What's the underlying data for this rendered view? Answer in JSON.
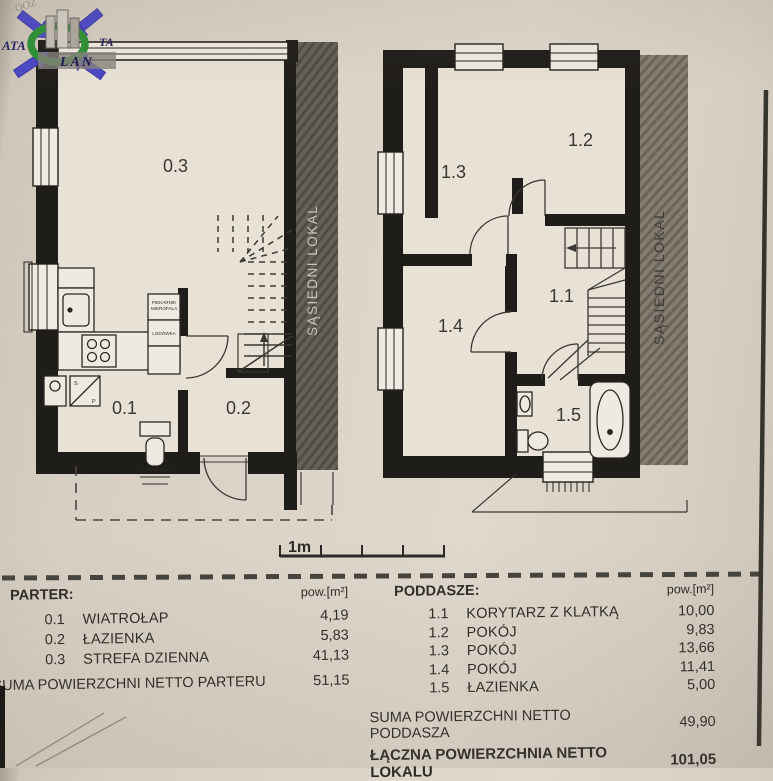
{
  "logo": {
    "text_left": "ATA",
    "text_right": "TA",
    "text_bottom": "LAN",
    "corner_script": "OOZ",
    "arrow_color": "#4b48c6",
    "ring_color": "#2d9136"
  },
  "plans": {
    "parter": {
      "rooms": {
        "r01": "0.1",
        "r02": "0.2",
        "r03": "0.3"
      },
      "adjacent_label": "SĄSIEDNI LOKAL",
      "kitchen": {
        "oven_line1": "PIEKARNIK",
        "oven_line2": "MIKROFALA",
        "fridge": "LODÓWKA"
      },
      "washer_letters": {
        "top": "S",
        "bottom": "P"
      }
    },
    "poddasze": {
      "rooms": {
        "r11": "1.1",
        "r12": "1.2",
        "r13": "1.3",
        "r14": "1.4",
        "r15": "1.5"
      },
      "adjacent_label": "SĄSIEDNI LOKAL"
    }
  },
  "scale_bar": {
    "label": "1m"
  },
  "tables": {
    "parter": {
      "title": "PARTER:",
      "unit_header": "pow.[m²]",
      "rows": [
        {
          "no": "0.1",
          "name": "WIATROŁAP",
          "area": "4,19"
        },
        {
          "no": "0.2",
          "name": "ŁAZIENKA",
          "area": "5,83"
        },
        {
          "no": "0.3",
          "name": "STREFA DZIENNA",
          "area": "41,13"
        }
      ],
      "total_label": "SUMA POWIERZCHNI NETTO PARTERU",
      "total_value": "51,15"
    },
    "poddasze": {
      "title": "PODDASZE:",
      "unit_header": "pow.[m²]",
      "rows": [
        {
          "no": "1.1",
          "name": "KORYTARZ Z KLATKĄ",
          "area": "10,00"
        },
        {
          "no": "1.2",
          "name": "POKÓJ",
          "area": "9,83"
        },
        {
          "no": "1.3",
          "name": "POKÓJ",
          "area": "13,66"
        },
        {
          "no": "1.4",
          "name": "POKÓJ",
          "area": "11,41"
        },
        {
          "no": "1.5",
          "name": "ŁAZIENKA",
          "area": "5,00"
        }
      ],
      "total_label": "SUMA POWIERZCHNI NETTO PODDASZA",
      "total_value": "49,90",
      "grand_total_label": "ŁĄCZNA POWIERZCHNIA NETTO LOKALU",
      "grand_total_value": "101,05"
    }
  },
  "colors": {
    "paper": "#dcd3c8",
    "wall": "#1f1d19",
    "neighbor_band_dark": "#5f5a52",
    "neighbor_band_light": "#7c766b"
  }
}
